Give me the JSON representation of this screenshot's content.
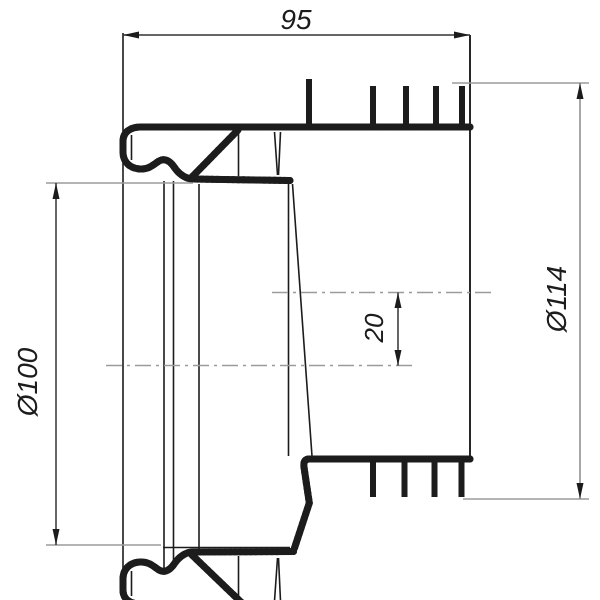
{
  "colors": {
    "background": "#ffffff",
    "line": "#1c1c1c",
    "ext": "#9b9b9b",
    "dim": "#333333",
    "dim_light": "#8a8a8a",
    "text": "#1c1c1c"
  },
  "drawing": {
    "dim_length_label": "95",
    "dim_small_dia_label": "Ø100",
    "dim_large_dia_label": "Ø114",
    "dim_offset_label": "20"
  }
}
